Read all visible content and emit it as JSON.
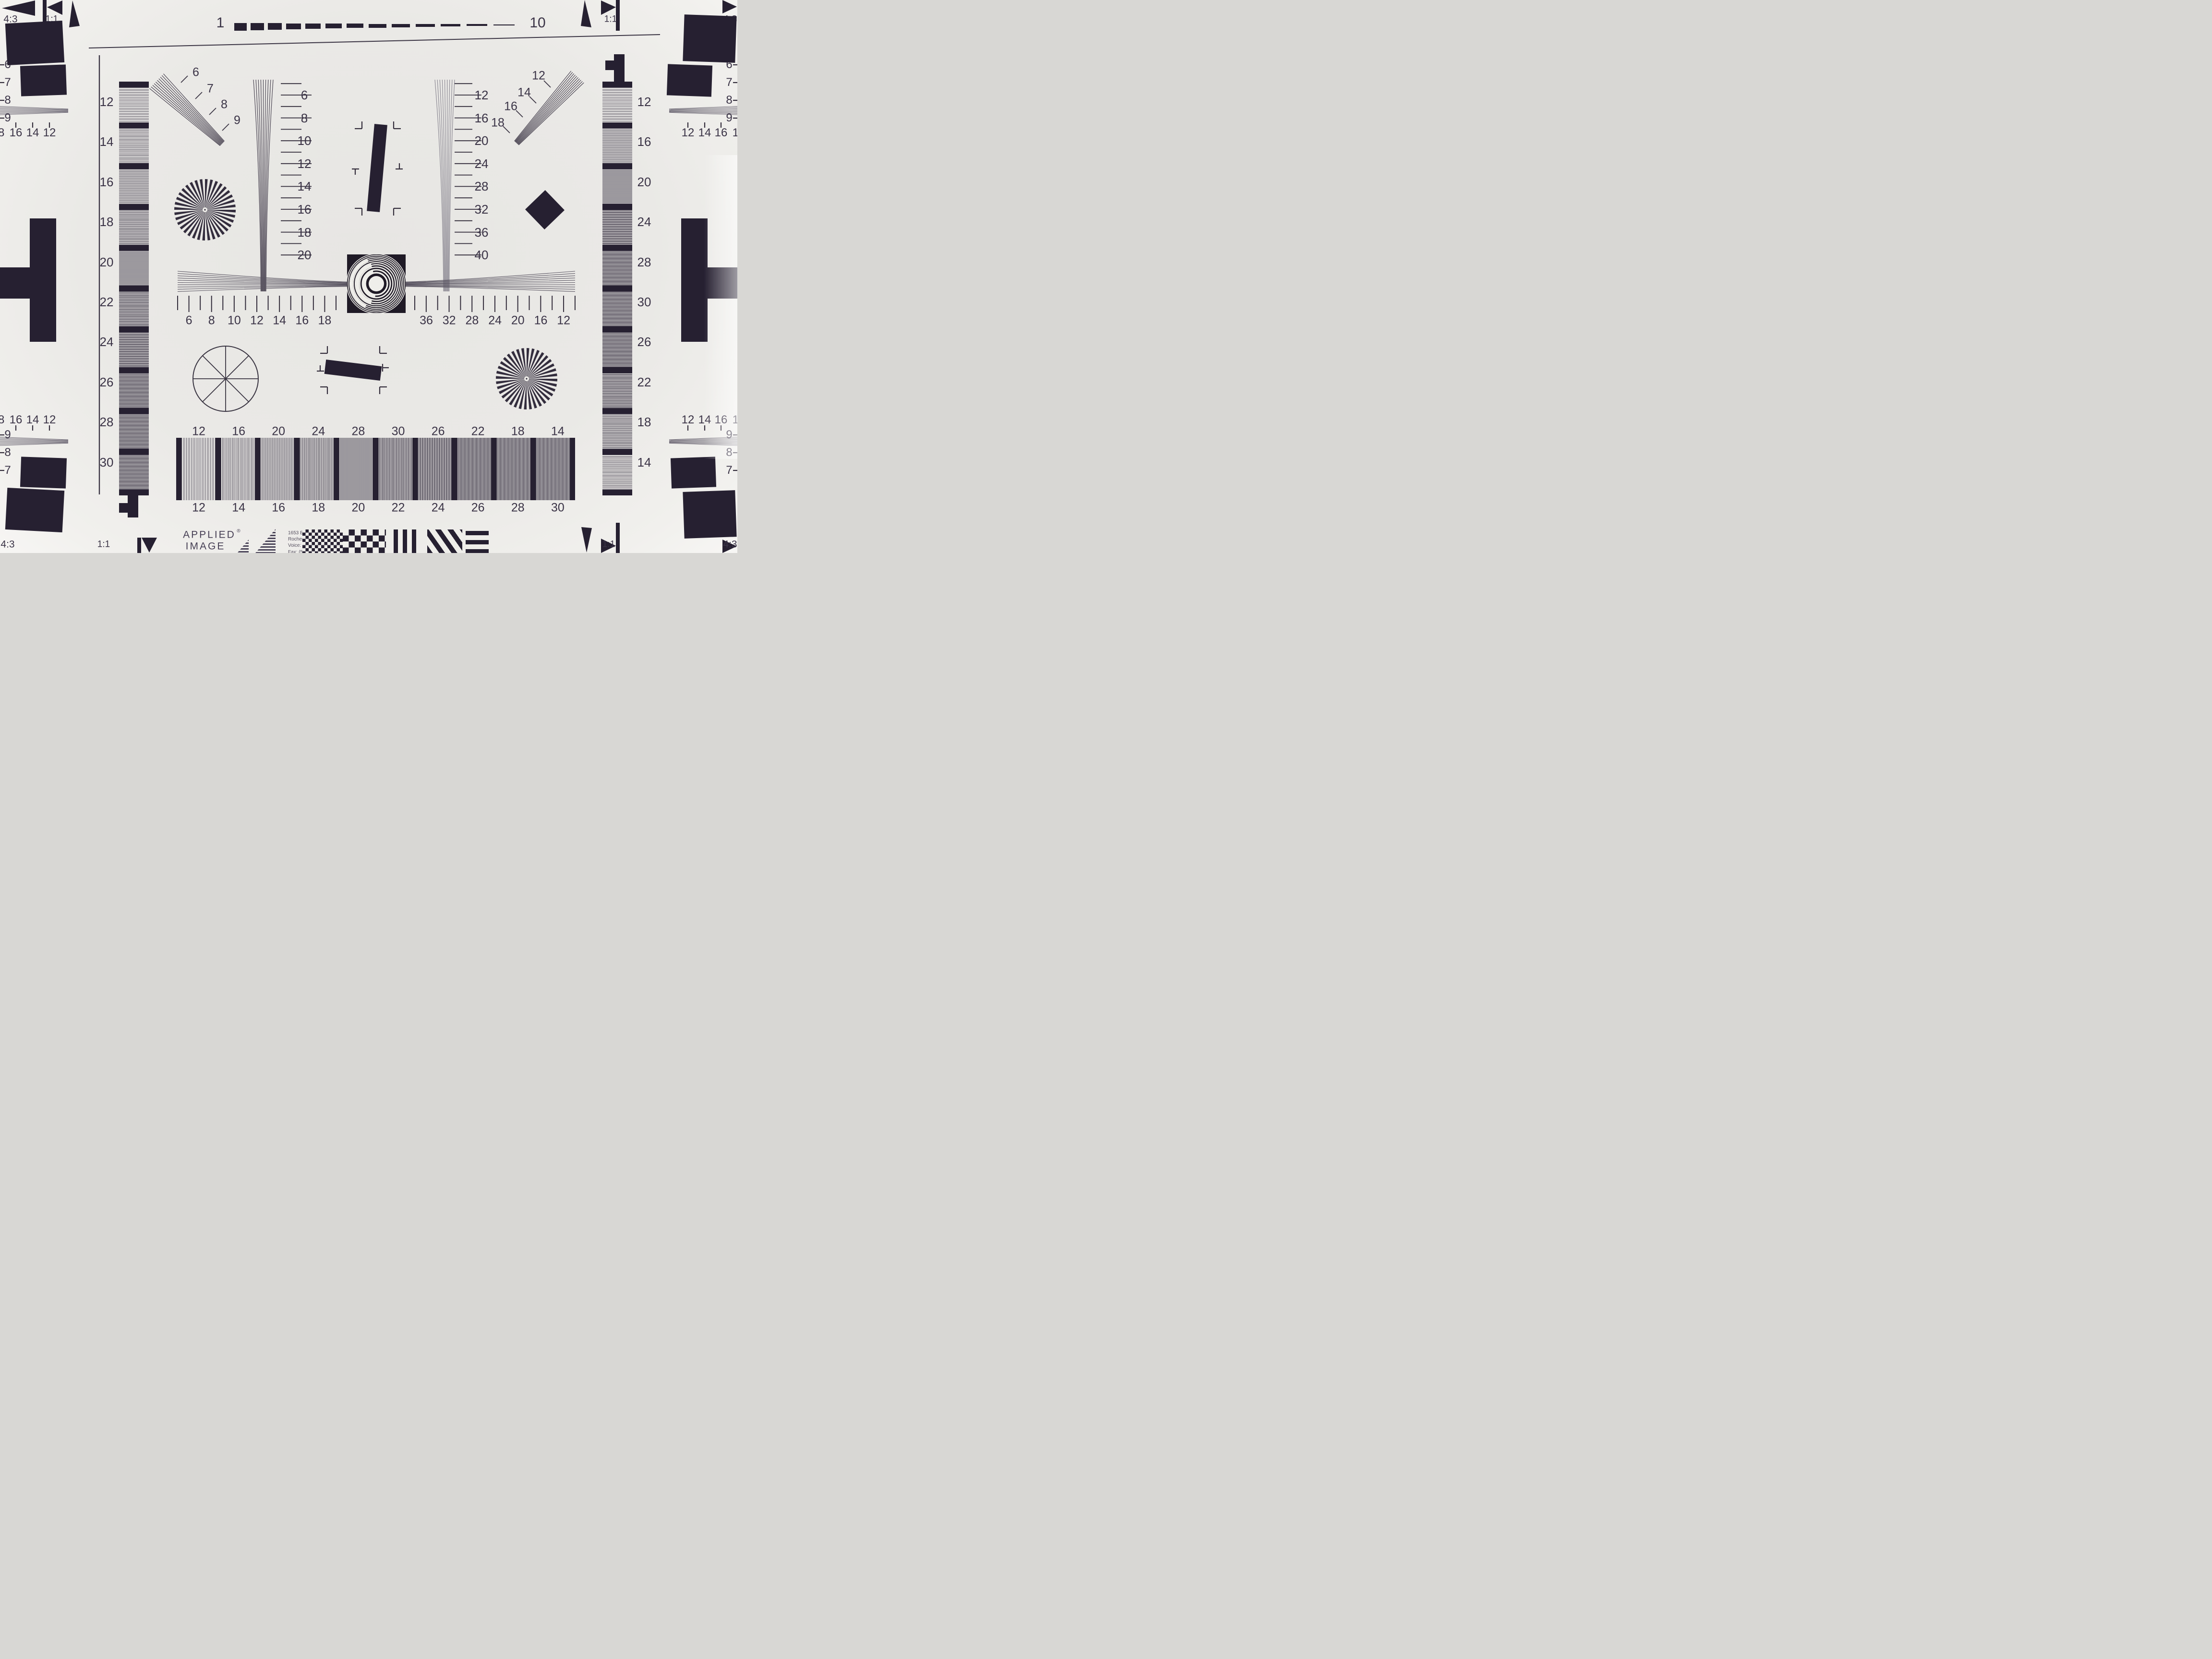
{
  "corners": {
    "tl_ratio": "4:3",
    "tl_square": "1:1",
    "tr_square": "1:1",
    "tr_ratio": "4:3",
    "bl_ratio": "4:3",
    "bl_square": "1:1",
    "br_square": "1:1",
    "br_ratio": "4:3"
  },
  "top_ruler": {
    "start": "1",
    "end": "10"
  },
  "left_strip_labels": [
    "12",
    "14",
    "16",
    "18",
    "20",
    "22",
    "24",
    "26",
    "28",
    "30"
  ],
  "right_strip_labels": [
    "12",
    "16",
    "20",
    "24",
    "28",
    "30",
    "26",
    "22",
    "18",
    "14"
  ],
  "ul_fan_labels": [
    "6",
    "7",
    "8",
    "9"
  ],
  "ur_fan_labels": [
    "12",
    "14",
    "16",
    "18"
  ],
  "center_wedge_labels": [
    "6",
    "8",
    "10",
    "12",
    "14",
    "16",
    "18",
    "20"
  ],
  "right_wedge_labels": [
    "12",
    "16",
    "20",
    "24",
    "28",
    "32",
    "36",
    "40"
  ],
  "h_scale_left_labels": [
    "6",
    "8",
    "10",
    "12",
    "14",
    "16",
    "18"
  ],
  "h_scale_right_labels": [
    "36",
    "32",
    "28",
    "24",
    "20",
    "16",
    "12"
  ],
  "bottom_wedge_top_labels": [
    "12",
    "16",
    "20",
    "24",
    "28",
    "30",
    "26",
    "22",
    "18",
    "14"
  ],
  "bottom_wedge_bottom_labels": [
    "12",
    "14",
    "16",
    "18",
    "20",
    "22",
    "24",
    "26",
    "28",
    "30"
  ],
  "left_edge_v_top": [
    "6",
    "7",
    "8",
    "9"
  ],
  "right_edge_v_top": [
    "6",
    "7",
    "8",
    "9"
  ],
  "left_edge_v_bottom": [
    "9",
    "8",
    "7"
  ],
  "right_edge_v_bottom": [
    "9",
    "8",
    "7"
  ],
  "left_edge_h": [
    "18",
    "16",
    "14",
    "12"
  ],
  "right_edge_h": [
    "12",
    "14",
    "16",
    "18"
  ],
  "logo": {
    "line1": "APPLIED",
    "reg": "®",
    "line2": "IMAGE",
    "line3": "Inc",
    "address": [
      "1653 East Main Street",
      "Rochester, NY  14609  USA",
      "Voice:   (585) 482-0300",
      "Fax:      (585) 288-5989",
      "www.appliedimage.com"
    ]
  },
  "colors": {
    "ink": "#262031",
    "line": "#3c3645",
    "gray_line": "#8d8a94",
    "paper": "#efeeea"
  }
}
